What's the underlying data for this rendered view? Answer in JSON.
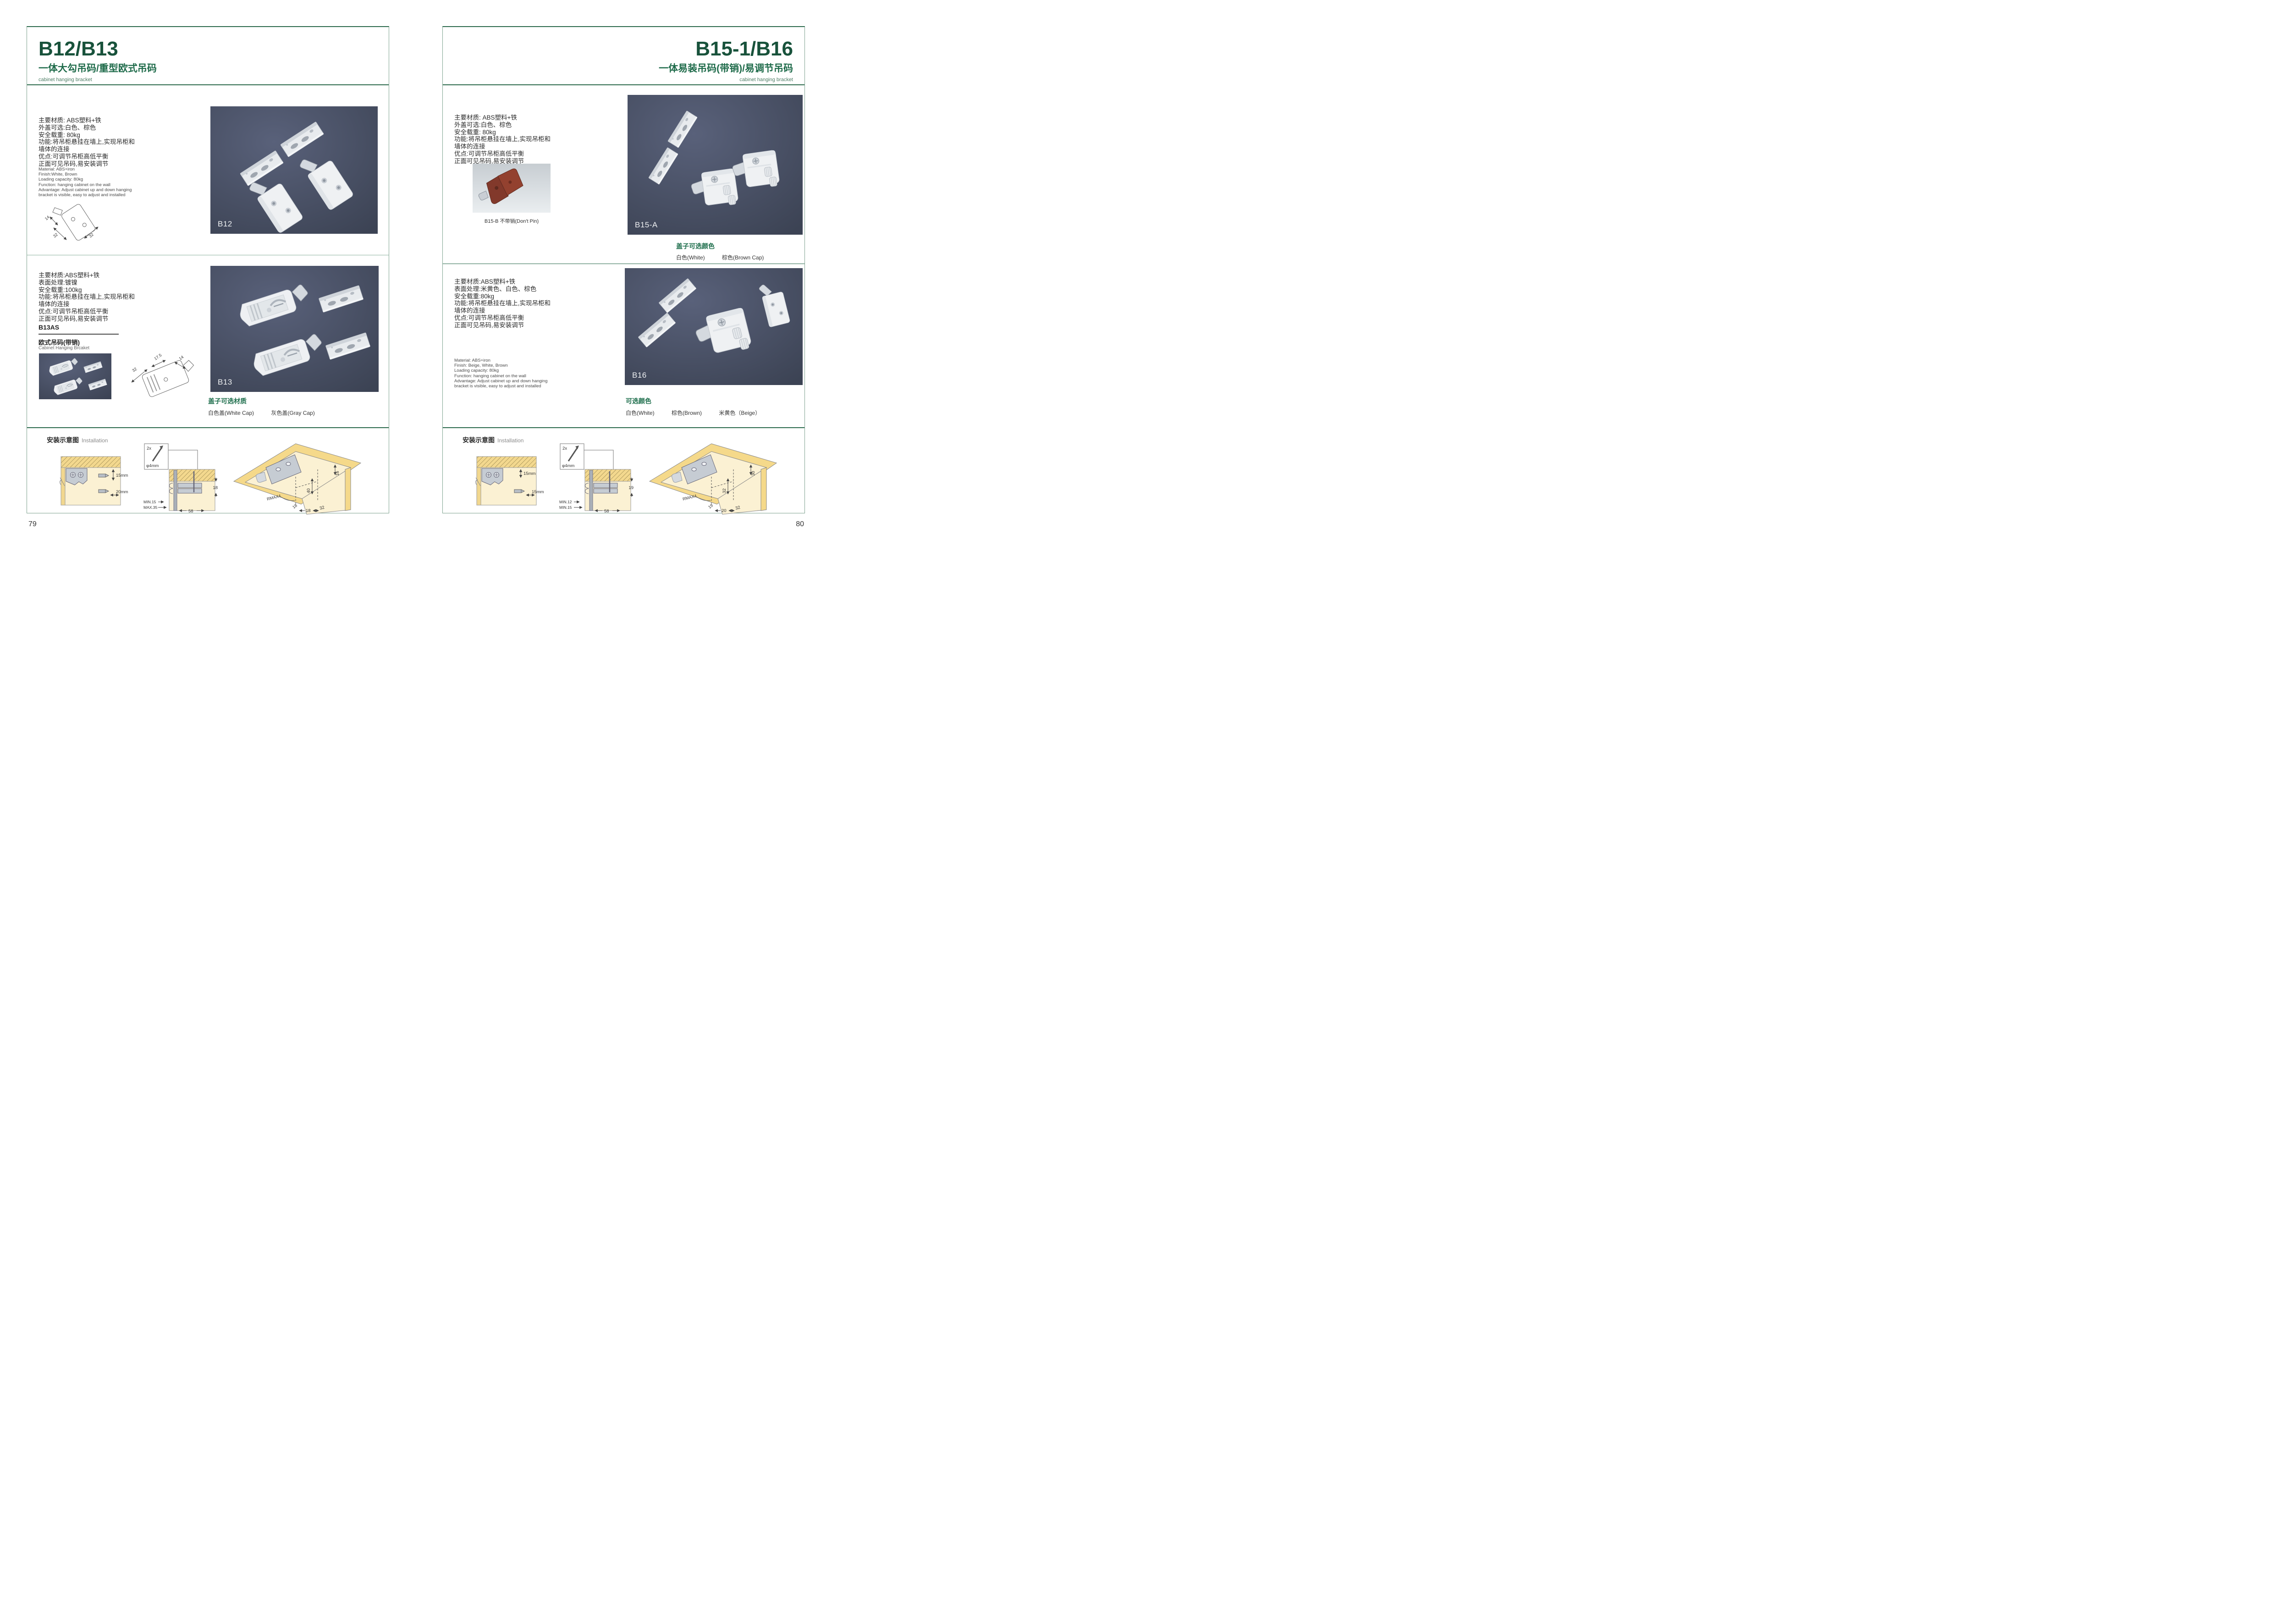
{
  "meta": {
    "accent_green": "#18523b",
    "heading_green": "#1e6e4c",
    "photo_bg": "#485066",
    "wood_yellow": "#f3d88e"
  },
  "left": {
    "page_number": "79",
    "title": "B12/B13",
    "subtitle": "一体大勾吊码/重型欧式吊码",
    "subtitle_en": "cabinet hanging bracket",
    "b12": {
      "specs_cn": [
        "主要材质: ABS塑料+铁",
        "外盖可选:白色、棕色",
        "安全载重: 80kg",
        "功能:将吊柜悬挂在墙上,实现吊柜和",
        "墙体的连接",
        "优点:可调节吊柜高低平衡",
        "正面可见吊码,易安装调节"
      ],
      "specs_en": [
        "Material: ABS+iron",
        "Finish:White, Brown",
        "Loading capacity: 80kg",
        "Function: hanging cabinet on the wall",
        "Advantage: Adjust cabinet up and down hanging",
        "bracket is visible, easy to adjust and installed"
      ],
      "drawing_dims": [
        "14",
        "32",
        "32"
      ],
      "photo_label": "B12"
    },
    "b13": {
      "specs_cn": [
        "主要材质:ABS塑料+铁",
        "表面处理:镀镍",
        "安全载重:100kg",
        "功能:将吊柜悬挂在墙上,实现吊柜和",
        "墙体的连接",
        "优点:可调节吊柜高低平衡",
        "正面可见吊码,易安装调节"
      ],
      "model": "B13AS",
      "model_cn": "欧式吊码(带销)",
      "model_en": "Cabinet Hanging Brcaket",
      "drawing_dims": [
        "32",
        "17.5",
        "14"
      ],
      "photo_label": "B13",
      "caps_title": "盖子可选材质",
      "caps": [
        "白色盖(White Cap)",
        "灰色盖(Gray Cap)"
      ]
    },
    "install": {
      "title_cn": "安装示意图",
      "title_en": "Installation",
      "d1_dims": [
        "15mm",
        "20mm"
      ],
      "screw": [
        "2x",
        "φ4mm"
      ],
      "d2_dims": [
        "18",
        "MIN.15",
        "MAX.35",
        "58"
      ],
      "d3_dims": [
        "16",
        "40",
        "RMAX4",
        "18",
        "18",
        "32"
      ]
    }
  },
  "right": {
    "page_number": "80",
    "title": "B15-1/B16",
    "subtitle": "一体易装吊码(带销)/易调节吊码",
    "subtitle_en": "cabinet hanging bracket",
    "b15": {
      "specs_cn": [
        "主要材质: ABS塑料+铁",
        "外盖可选:白色、棕色",
        "安全载重: 80kg",
        "功能:将吊柜悬挂在墙上,实现吊柜和",
        "墙体的连接",
        "优点:可调节吊柜高低平衡",
        "正面可见吊码,易安装调节"
      ],
      "small_photo_caption": "B15-B 不带销(Don't Pin)",
      "photo_label": "B15-A",
      "caps_title": "盖子可选颜色",
      "caps": [
        "白色(White)",
        "棕色(Brown Cap)"
      ]
    },
    "b16": {
      "specs_cn": [
        "主要材质:ABS塑料+铁",
        "表面处理:米黄色、白色、棕色",
        "安全载重:80kg",
        "功能:将吊柜悬挂在墙上,实现吊柜和",
        "墙体的连接",
        "优点:可调节吊柜高低平衡",
        "正面可见吊码,易安装调节"
      ],
      "specs_en": [
        "Material: ABS+iron",
        "Finish: Beige, White, Brown",
        "Loading capacity: 80kg",
        "Function: hanging cabinet on the wall",
        "Advantage: Adjust cabinet up and down hanging",
        "bracket is visible, easy to adjust and installed"
      ],
      "photo_label": "B16",
      "colors_title": "可选颜色",
      "colors": [
        "白色(White)",
        "棕色(Brown)",
        "米黄色（Beige）"
      ]
    },
    "install": {
      "title_cn": "安装示意图",
      "title_en": "Installation",
      "d1_dims": [
        "15mm",
        "15mm"
      ],
      "screw": [
        "2x",
        "φ4mm"
      ],
      "d2_dims": [
        "19",
        "MIN.12",
        "MIN.15",
        "58"
      ],
      "d3_dims": [
        "30",
        "32",
        "RMAX4",
        "19",
        "20",
        "32"
      ]
    }
  }
}
